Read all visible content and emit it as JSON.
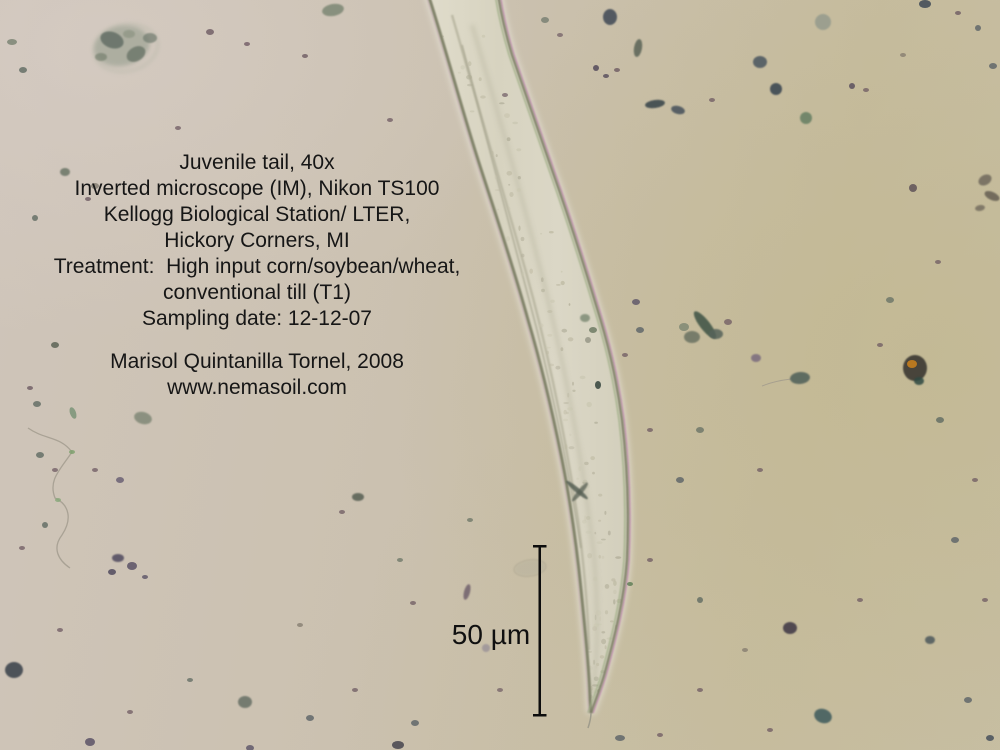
{
  "annotation": {
    "lines": [
      "Juvenile tail, 40x",
      "Inverted microscope (IM), Nikon TS100",
      "Kellogg Biological Station/ LTER,",
      "Hickory Corners, MI",
      "Treatment:  High input corn/soybean/wheat,",
      "conventional till (T1)",
      "Sampling date: 12-12-07"
    ],
    "credit": "Marisol Quintanilla Tornel, 2008",
    "website": "www.nemasoil.com"
  },
  "scale_bar": {
    "label": "50 µm"
  },
  "colors": {
    "text": "#161616",
    "bg_warm_gray": "#cfc5ba",
    "bg_olive_tan": "#c2b893",
    "worm_fill_light": "#e0dccb",
    "worm_fill_mid": "#d7d3c0",
    "worm_fill_mid2": "#dbd7c6",
    "worm_fill_dark": "#d3cfbc",
    "worm_edge": "#7f8168",
    "worm_halo": "#e3dfd2",
    "fringe_pink": "#c08fae",
    "fringe_green": "#9fae86",
    "scale_bar_ink": "#0d0d0d",
    "amber_particle": "#b87820"
  },
  "particles": [
    {
      "x": 122,
      "y": 46,
      "rx": 28,
      "ry": 20,
      "rot": -12,
      "c": "#99a091",
      "o": 0.65,
      "b": 2
    },
    {
      "x": 112,
      "y": 40,
      "rx": 12,
      "ry": 8,
      "rot": 20,
      "c": "#5f6a62",
      "o": 0.8,
      "b": 1
    },
    {
      "x": 136,
      "y": 54,
      "rx": 10,
      "ry": 7,
      "rot": -30,
      "c": "#6a7568",
      "o": 0.8,
      "b": 1
    },
    {
      "x": 150,
      "y": 38,
      "rx": 7,
      "ry": 5,
      "c": "#707a6e",
      "o": 0.7,
      "b": 1
    },
    {
      "x": 101,
      "y": 57,
      "rx": 6,
      "ry": 4,
      "c": "#77816f",
      "o": 0.7,
      "b": 1
    },
    {
      "x": 129,
      "y": 34,
      "rx": 6,
      "ry": 4,
      "c": "#8d9483",
      "o": 0.7,
      "b": 1
    },
    {
      "x": 210,
      "y": 32,
      "rx": 4,
      "ry": 3,
      "c": "#6d5a62",
      "o": 0.8
    },
    {
      "x": 247,
      "y": 44,
      "rx": 3,
      "ry": 2,
      "c": "#705a64",
      "o": 0.8
    },
    {
      "x": 333,
      "y": 10,
      "rx": 11,
      "ry": 6,
      "rot": -10,
      "c": "#77836f",
      "o": 0.8,
      "b": 1
    },
    {
      "x": 305,
      "y": 56,
      "rx": 3,
      "ry": 2,
      "c": "#6d5a62",
      "o": 0.8
    },
    {
      "x": 23,
      "y": 70,
      "rx": 4,
      "ry": 3,
      "c": "#5f6a62",
      "o": 0.8
    },
    {
      "x": 12,
      "y": 42,
      "rx": 5,
      "ry": 3,
      "c": "#77816f",
      "o": 0.8
    },
    {
      "x": 65,
      "y": 172,
      "rx": 5,
      "ry": 4,
      "c": "#6a7466",
      "o": 0.85,
      "b": 1
    },
    {
      "x": 95,
      "y": 186,
      "rx": 4,
      "ry": 3,
      "c": "#817a6e",
      "o": 0.8
    },
    {
      "x": 88,
      "y": 199,
      "rx": 3,
      "ry": 2,
      "c": "#6d5a62",
      "o": 0.8
    },
    {
      "x": 35,
      "y": 218,
      "rx": 3,
      "ry": 3,
      "c": "#5f6a62",
      "o": 0.8
    },
    {
      "x": 178,
      "y": 128,
      "rx": 3,
      "ry": 2,
      "c": "#6d5a62",
      "o": 0.75
    },
    {
      "x": 390,
      "y": 120,
      "rx": 3,
      "ry": 2,
      "c": "#6d5a62",
      "o": 0.75
    },
    {
      "x": 55,
      "y": 345,
      "rx": 4,
      "ry": 3,
      "c": "#5c6456",
      "o": 0.85
    },
    {
      "x": 30,
      "y": 388,
      "rx": 3,
      "ry": 2,
      "c": "#6d5a62",
      "o": 0.8
    },
    {
      "x": 37,
      "y": 404,
      "rx": 4,
      "ry": 3,
      "c": "#5f6a62",
      "o": 0.8
    },
    {
      "x": 143,
      "y": 418,
      "rx": 9,
      "ry": 6,
      "rot": 15,
      "c": "#76806e",
      "o": 0.75,
      "b": 1
    },
    {
      "x": 73,
      "y": 413,
      "rx": 6,
      "ry": 3,
      "rot": 70,
      "c": "#6a8a6a",
      "o": 0.7
    },
    {
      "x": 120,
      "y": 480,
      "rx": 4,
      "ry": 3,
      "c": "#645a70",
      "o": 0.8
    },
    {
      "x": 95,
      "y": 470,
      "rx": 3,
      "ry": 2,
      "c": "#6d5a62",
      "o": 0.75
    },
    {
      "x": 40,
      "y": 455,
      "rx": 4,
      "ry": 3,
      "c": "#5f6a62",
      "o": 0.8
    },
    {
      "x": 55,
      "y": 470,
      "rx": 3,
      "ry": 2,
      "c": "#6d5a62",
      "o": 0.75
    },
    {
      "x": 72,
      "y": 452,
      "rx": 3,
      "ry": 2,
      "c": "#7aa06a",
      "o": 0.8
    },
    {
      "x": 58,
      "y": 500,
      "rx": 3,
      "ry": 2,
      "c": "#86a878",
      "o": 0.8
    },
    {
      "x": 118,
      "y": 558,
      "rx": 6,
      "ry": 4,
      "c": "#504a5e",
      "o": 0.85,
      "b": 1
    },
    {
      "x": 132,
      "y": 566,
      "rx": 5,
      "ry": 4,
      "c": "#5a5266",
      "o": 0.85
    },
    {
      "x": 112,
      "y": 572,
      "rx": 4,
      "ry": 3,
      "c": "#504a5e",
      "o": 0.85
    },
    {
      "x": 145,
      "y": 577,
      "rx": 3,
      "ry": 2,
      "c": "#5a5266",
      "o": 0.8
    },
    {
      "x": 45,
      "y": 525,
      "rx": 3,
      "ry": 3,
      "c": "#5f6a62",
      "o": 0.8
    },
    {
      "x": 22,
      "y": 548,
      "rx": 3,
      "ry": 2,
      "c": "#6d5a62",
      "o": 0.75
    },
    {
      "x": 14,
      "y": 670,
      "rx": 9,
      "ry": 8,
      "c": "#414750",
      "o": 0.9,
      "b": 1
    },
    {
      "x": 60,
      "y": 630,
      "rx": 3,
      "ry": 2,
      "c": "#6d5a62",
      "o": 0.75
    },
    {
      "x": 90,
      "y": 742,
      "rx": 5,
      "ry": 4,
      "c": "#5a5266",
      "o": 0.85
    },
    {
      "x": 130,
      "y": 712,
      "rx": 3,
      "ry": 2,
      "c": "#6d5a62",
      "o": 0.75
    },
    {
      "x": 190,
      "y": 680,
      "rx": 3,
      "ry": 2,
      "c": "#5f6a62",
      "o": 0.75
    },
    {
      "x": 245,
      "y": 702,
      "rx": 7,
      "ry": 6,
      "c": "#606a60",
      "o": 0.8,
      "b": 1
    },
    {
      "x": 310,
      "y": 718,
      "rx": 4,
      "ry": 3,
      "c": "#5a6266",
      "o": 0.8
    },
    {
      "x": 355,
      "y": 690,
      "rx": 3,
      "ry": 2,
      "c": "#6d5a62",
      "o": 0.75
    },
    {
      "x": 398,
      "y": 745,
      "rx": 6,
      "ry": 4,
      "c": "#46444e",
      "o": 0.85
    },
    {
      "x": 250,
      "y": 748,
      "rx": 4,
      "ry": 3,
      "c": "#5a5266",
      "o": 0.8
    },
    {
      "x": 358,
      "y": 497,
      "rx": 6,
      "ry": 4,
      "c": "#565e52",
      "o": 0.85,
      "b": 1
    },
    {
      "x": 342,
      "y": 512,
      "rx": 3,
      "ry": 2,
      "c": "#6d5a62",
      "o": 0.75
    },
    {
      "x": 400,
      "y": 560,
      "rx": 3,
      "ry": 2,
      "c": "#6a7466",
      "o": 0.75
    },
    {
      "x": 415,
      "y": 723,
      "rx": 4,
      "ry": 3,
      "c": "#5a6266",
      "o": 0.8
    },
    {
      "x": 300,
      "y": 625,
      "rx": 3,
      "ry": 2,
      "c": "#817a6e",
      "o": 0.75
    },
    {
      "x": 470,
      "y": 520,
      "rx": 3,
      "ry": 2,
      "c": "#6a7466",
      "o": 0.75
    },
    {
      "x": 467,
      "y": 592,
      "rx": 3,
      "ry": 8,
      "rot": 15,
      "c": "#6a5a68",
      "o": 0.8,
      "b": 1
    },
    {
      "x": 413,
      "y": 603,
      "rx": 3,
      "ry": 2,
      "c": "#6d5a62",
      "o": 0.75
    },
    {
      "x": 486,
      "y": 648,
      "rx": 4,
      "ry": 4,
      "c": "#8a8292",
      "o": 0.6,
      "b": 1
    },
    {
      "x": 500,
      "y": 690,
      "rx": 3,
      "ry": 2,
      "c": "#6d5a62",
      "o": 0.7
    },
    {
      "x": 530,
      "y": 568,
      "rx": 15,
      "ry": 7,
      "rot": -8,
      "c": "#b8b29e",
      "o": 0.55,
      "b": 1
    },
    {
      "x": 505,
      "y": 95,
      "rx": 3,
      "ry": 2,
      "c": "#6d5a62",
      "o": 0.7
    },
    {
      "x": 545,
      "y": 20,
      "rx": 4,
      "ry": 3,
      "c": "#6a7466",
      "o": 0.7
    },
    {
      "x": 560,
      "y": 35,
      "rx": 3,
      "ry": 2,
      "c": "#6d5a62",
      "o": 0.7
    },
    {
      "x": 610,
      "y": 17,
      "rx": 7,
      "ry": 8,
      "c": "#46505a",
      "o": 0.9,
      "b": 1
    },
    {
      "x": 638,
      "y": 48,
      "rx": 4,
      "ry": 9,
      "rot": 10,
      "c": "#5a6456",
      "o": 0.85,
      "b": 1
    },
    {
      "x": 596,
      "y": 68,
      "rx": 3,
      "ry": 3,
      "c": "#544a5a",
      "o": 0.85
    },
    {
      "x": 606,
      "y": 76,
      "rx": 3,
      "ry": 2,
      "c": "#544a5a",
      "o": 0.8
    },
    {
      "x": 617,
      "y": 70,
      "rx": 3,
      "ry": 2,
      "c": "#6d5a62",
      "o": 0.8
    },
    {
      "x": 655,
      "y": 104,
      "rx": 10,
      "ry": 4,
      "rot": -8,
      "c": "#3e4a4e",
      "o": 0.9,
      "b": 1
    },
    {
      "x": 678,
      "y": 110,
      "rx": 7,
      "ry": 4,
      "rot": 15,
      "c": "#44505a",
      "o": 0.85,
      "b": 1
    },
    {
      "x": 712,
      "y": 100,
      "rx": 3,
      "ry": 2,
      "c": "#6d5a62",
      "o": 0.75
    },
    {
      "x": 760,
      "y": 62,
      "rx": 7,
      "ry": 6,
      "c": "#4a545e",
      "o": 0.85,
      "b": 1
    },
    {
      "x": 776,
      "y": 89,
      "rx": 6,
      "ry": 6,
      "c": "#3e4852",
      "o": 0.9,
      "b": 1
    },
    {
      "x": 823,
      "y": 22,
      "rx": 8,
      "ry": 8,
      "c": "#8e968a",
      "o": 0.75,
      "b": 1
    },
    {
      "x": 806,
      "y": 118,
      "rx": 6,
      "ry": 6,
      "c": "#5e7a5e",
      "o": 0.8,
      "b": 1
    },
    {
      "x": 852,
      "y": 86,
      "rx": 3,
      "ry": 3,
      "c": "#544a5a",
      "o": 0.8
    },
    {
      "x": 866,
      "y": 90,
      "rx": 3,
      "ry": 2,
      "c": "#6d5a62",
      "o": 0.75
    },
    {
      "x": 925,
      "y": 4,
      "rx": 6,
      "ry": 4,
      "c": "#46505a",
      "o": 0.9
    },
    {
      "x": 958,
      "y": 13,
      "rx": 3,
      "ry": 2,
      "c": "#6d5a62",
      "o": 0.8
    },
    {
      "x": 978,
      "y": 28,
      "rx": 3,
      "ry": 3,
      "c": "#5a6266",
      "o": 0.8
    },
    {
      "x": 993,
      "y": 66,
      "rx": 4,
      "ry": 3,
      "c": "#5a6266",
      "o": 0.8
    },
    {
      "x": 903,
      "y": 55,
      "rx": 3,
      "ry": 2,
      "c": "#817a6e",
      "o": 0.75
    },
    {
      "x": 985,
      "y": 180,
      "rx": 7,
      "ry": 5,
      "rot": -30,
      "c": "#6a6458",
      "o": 0.8,
      "b": 1
    },
    {
      "x": 992,
      "y": 196,
      "rx": 8,
      "ry": 4,
      "rot": 25,
      "c": "#5e584e",
      "o": 0.8,
      "b": 1
    },
    {
      "x": 980,
      "y": 208,
      "rx": 5,
      "ry": 3,
      "rot": -10,
      "c": "#6a6458",
      "o": 0.75,
      "b": 1
    },
    {
      "x": 913,
      "y": 188,
      "rx": 4,
      "ry": 4,
      "c": "#5e5258",
      "o": 0.85
    },
    {
      "x": 938,
      "y": 262,
      "rx": 3,
      "ry": 2,
      "c": "#6d5a62",
      "o": 0.75
    },
    {
      "x": 890,
      "y": 300,
      "rx": 4,
      "ry": 3,
      "c": "#6a7466",
      "o": 0.8
    },
    {
      "x": 880,
      "y": 345,
      "rx": 3,
      "ry": 2,
      "c": "#6d5a62",
      "o": 0.75
    },
    {
      "x": 940,
      "y": 420,
      "rx": 4,
      "ry": 3,
      "c": "#5f6a62",
      "o": 0.8
    },
    {
      "x": 975,
      "y": 480,
      "rx": 3,
      "ry": 2,
      "c": "#6d5a62",
      "o": 0.75
    },
    {
      "x": 955,
      "y": 540,
      "rx": 4,
      "ry": 3,
      "c": "#5a6266",
      "o": 0.8
    },
    {
      "x": 985,
      "y": 600,
      "rx": 3,
      "ry": 2,
      "c": "#6d5a62",
      "o": 0.75
    },
    {
      "x": 930,
      "y": 640,
      "rx": 5,
      "ry": 4,
      "c": "#4e585c",
      "o": 0.85,
      "b": 1
    },
    {
      "x": 968,
      "y": 700,
      "rx": 4,
      "ry": 3,
      "c": "#5a6266",
      "o": 0.8
    },
    {
      "x": 990,
      "y": 738,
      "rx": 4,
      "ry": 3,
      "c": "#46505a",
      "o": 0.85
    },
    {
      "x": 705,
      "y": 325,
      "rx": 17,
      "ry": 5,
      "rot": 52,
      "c": "#44584a",
      "o": 0.9,
      "b": 1
    },
    {
      "x": 692,
      "y": 337,
      "rx": 8,
      "ry": 6,
      "c": "#6a7262",
      "o": 0.85,
      "b": 1
    },
    {
      "x": 716,
      "y": 334,
      "rx": 7,
      "ry": 5,
      "c": "#57645a",
      "o": 0.85,
      "b": 1
    },
    {
      "x": 684,
      "y": 327,
      "rx": 5,
      "ry": 4,
      "c": "#7a8472",
      "o": 0.8
    },
    {
      "x": 728,
      "y": 322,
      "rx": 4,
      "ry": 3,
      "c": "#6d5a62",
      "o": 0.75
    },
    {
      "x": 636,
      "y": 302,
      "rx": 4,
      "ry": 3,
      "c": "#5a5266",
      "o": 0.8
    },
    {
      "x": 756,
      "y": 358,
      "rx": 5,
      "ry": 4,
      "c": "#6a5a78",
      "o": 0.7,
      "b": 1
    },
    {
      "x": 800,
      "y": 378,
      "rx": 10,
      "ry": 6,
      "rot": -5,
      "c": "#4e5e58",
      "o": 0.85,
      "b": 1
    },
    {
      "x": 915,
      "y": 368,
      "rx": 12,
      "ry": 13,
      "c": "#3a3832",
      "o": 0.9,
      "b": 1
    },
    {
      "x": 912,
      "y": 364,
      "rx": 5,
      "ry": 4,
      "c": "#b87820",
      "o": 1
    },
    {
      "x": 919,
      "y": 381,
      "rx": 5,
      "ry": 4,
      "c": "#2e4a42",
      "o": 0.85,
      "b": 1
    },
    {
      "x": 585,
      "y": 318,
      "rx": 5,
      "ry": 4,
      "c": "#7a8872",
      "o": 0.8,
      "b": 1
    },
    {
      "x": 593,
      "y": 330,
      "rx": 4,
      "ry": 3,
      "c": "#68765e",
      "o": 0.8
    },
    {
      "x": 588,
      "y": 340,
      "rx": 3,
      "ry": 3,
      "c": "#8a8a7a",
      "o": 0.7
    },
    {
      "x": 598,
      "y": 385,
      "rx": 3,
      "ry": 4,
      "c": "#3c4a42",
      "o": 0.9
    },
    {
      "x": 630,
      "y": 584,
      "rx": 3,
      "ry": 2,
      "c": "#5a7a52",
      "o": 0.8
    },
    {
      "x": 577,
      "y": 490,
      "rx": 14,
      "ry": 2.5,
      "rot": 40,
      "c": "#4e584e",
      "o": 0.8,
      "b": 1
    },
    {
      "x": 580,
      "y": 492,
      "rx": 12,
      "ry": 2.5,
      "rot": -50,
      "c": "#565e52",
      "o": 0.75,
      "b": 1
    },
    {
      "x": 620,
      "y": 738,
      "rx": 5,
      "ry": 3,
      "c": "#5a6266",
      "o": 0.8
    },
    {
      "x": 660,
      "y": 735,
      "rx": 3,
      "ry": 2,
      "c": "#6d5a62",
      "o": 0.75
    },
    {
      "x": 700,
      "y": 690,
      "rx": 3,
      "ry": 2,
      "c": "#6d5a62",
      "o": 0.75
    },
    {
      "x": 745,
      "y": 650,
      "rx": 3,
      "ry": 2,
      "c": "#817a6e",
      "o": 0.75
    },
    {
      "x": 790,
      "y": 628,
      "rx": 7,
      "ry": 6,
      "c": "#453e48",
      "o": 0.9,
      "b": 1
    },
    {
      "x": 823,
      "y": 716,
      "rx": 9,
      "ry": 7,
      "rot": 20,
      "c": "#3e5a5c",
      "o": 0.85,
      "b": 1
    },
    {
      "x": 770,
      "y": 730,
      "rx": 3,
      "ry": 2,
      "c": "#6d5a62",
      "o": 0.75
    },
    {
      "x": 860,
      "y": 600,
      "rx": 3,
      "ry": 2,
      "c": "#6d5a62",
      "o": 0.75
    },
    {
      "x": 700,
      "y": 600,
      "rx": 3,
      "ry": 3,
      "c": "#5f6a62",
      "o": 0.8
    },
    {
      "x": 650,
      "y": 560,
      "rx": 3,
      "ry": 2,
      "c": "#6d5a62",
      "o": 0.75
    },
    {
      "x": 680,
      "y": 480,
      "rx": 4,
      "ry": 3,
      "c": "#5a6266",
      "o": 0.8
    },
    {
      "x": 650,
      "y": 430,
      "rx": 3,
      "ry": 2,
      "c": "#6d5a62",
      "o": 0.75
    },
    {
      "x": 700,
      "y": 430,
      "rx": 4,
      "ry": 3,
      "c": "#6a7466",
      "o": 0.8
    },
    {
      "x": 760,
      "y": 470,
      "rx": 3,
      "ry": 2,
      "c": "#6d5a62",
      "o": 0.75
    },
    {
      "x": 640,
      "y": 330,
      "rx": 4,
      "ry": 3,
      "c": "#5a6266",
      "o": 0.8
    },
    {
      "x": 625,
      "y": 355,
      "rx": 3,
      "ry": 2,
      "c": "#6d5a62",
      "o": 0.75
    }
  ]
}
